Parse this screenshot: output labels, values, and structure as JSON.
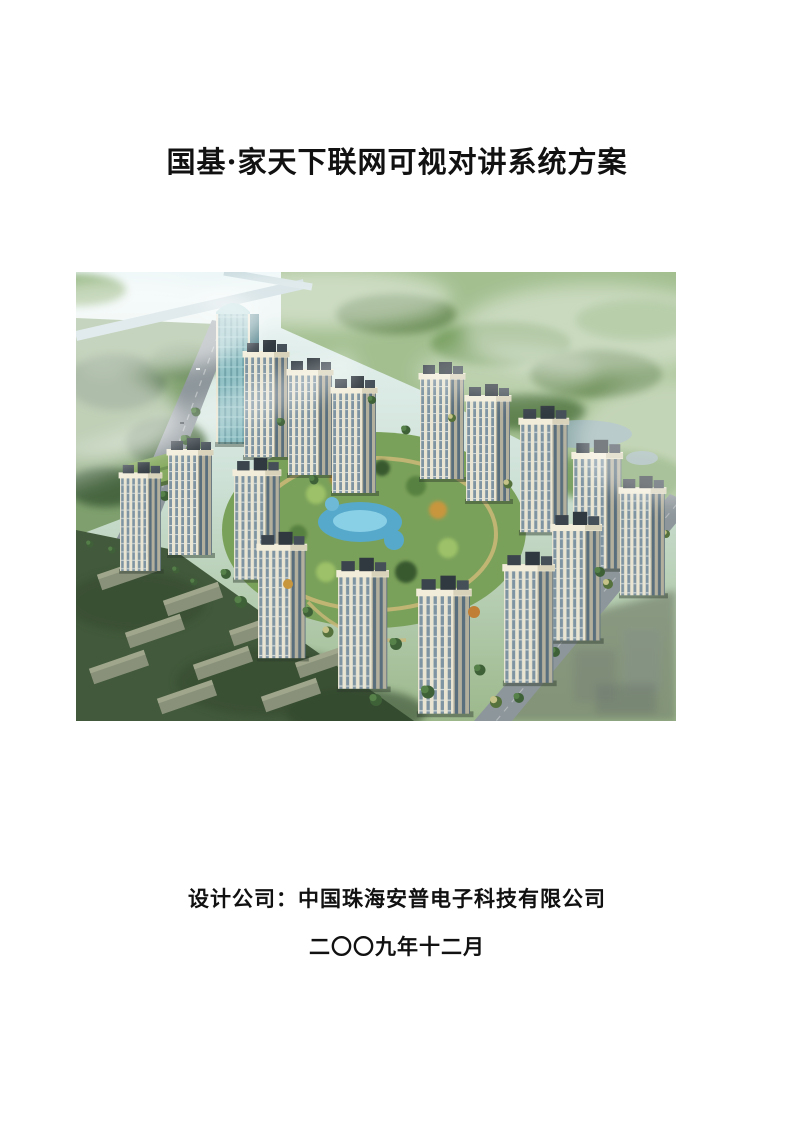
{
  "document": {
    "title": "国基·家天下联网可视对讲系统方案",
    "cover_image": "residential-complex-aerial-rendering",
    "footer": {
      "designer_line": "设计公司：中国珠海安普电子科技有限公司",
      "date_line": "二〇〇九年十二月"
    }
  }
}
